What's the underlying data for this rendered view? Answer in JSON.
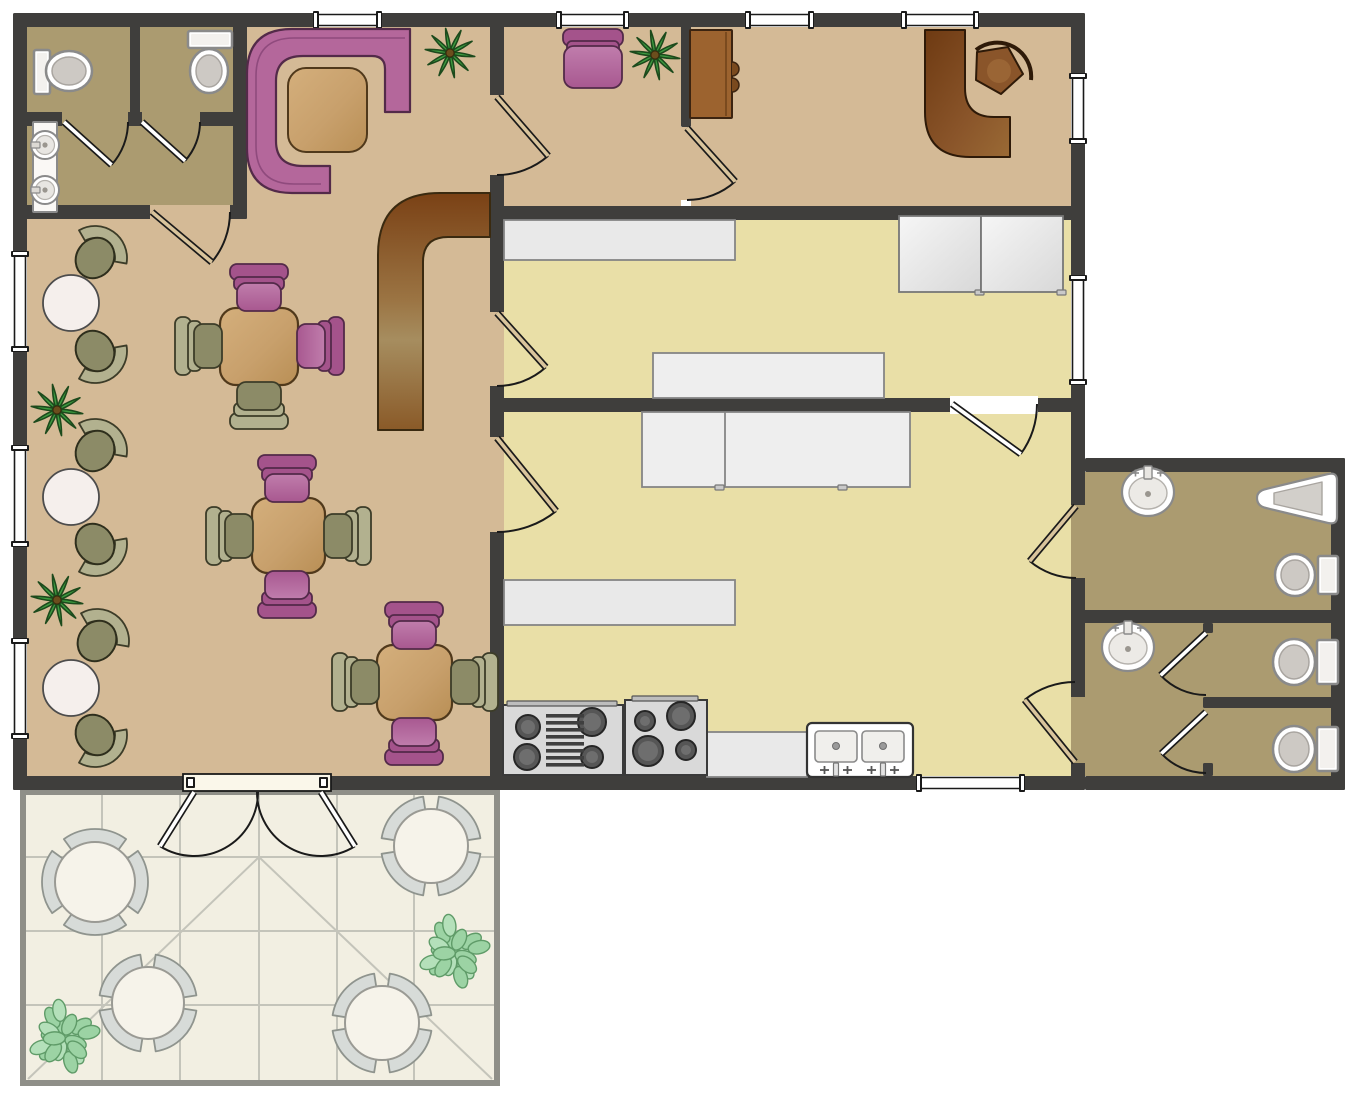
{
  "canvas": {
    "width": 1363,
    "height": 1100,
    "background": "#ffffff"
  },
  "colors": {
    "wall": "#3f3e3c",
    "dining": "#d4ba96",
    "khaki": "#ab9b70",
    "kitchen": "#e9dfa7",
    "patio": "#f2efe2",
    "patioLine": "#c4c4ba",
    "patioEdge": "#8f8f88",
    "white": "#ffffff",
    "counter": "#e9e9e9",
    "counterStroke": "#858585",
    "pink": "#b4679b",
    "pinkDark": "#a4538b",
    "pinkLight": "#c07dac",
    "pinkStroke": "#532a49",
    "olive": "#8c8b67",
    "oliveLight": "#b2b18f",
    "oliveStroke": "#3c3c28",
    "wood": "#c8a06c",
    "woodLight": "#d4af7c",
    "woodStroke": "#50391b",
    "green": "#3d9b40",
    "greenDark": "#1c4a1c",
    "bushGreen": "#9cd3a4",
    "bushGreenLight": "#b4e0ba",
    "bushStroke": "#5f9b68",
    "chairGray": "#d7dbd8",
    "chairGrayStroke": "#8f948e",
    "fixtureStroke": "#8a8a8a",
    "fixtureInner": "#d5d2cf",
    "tanDoor": "#d9c49c",
    "applianceGray": "#d9d9d9",
    "applianceStroke": "#3a3a3a",
    "burner": "#4f4f4f",
    "brownDark": "#7a4115",
    "brownMid": "#9b7443",
    "brownLight": "#a68d5f",
    "cabBrown": "#9c632f",
    "tableWhite": "#f5efec"
  },
  "floors": [
    {
      "name": "dining-room-floor",
      "x": 27,
      "y": 27,
      "w": 463,
      "h": 749,
      "fill": "dining"
    },
    {
      "name": "restroom-stalls-floor",
      "x": 27,
      "y": 27,
      "w": 206,
      "h": 85,
      "fill": "khaki"
    },
    {
      "name": "restroom-hall-floor",
      "x": 27,
      "y": 126,
      "w": 206,
      "h": 79,
      "fill": "khaki"
    },
    {
      "name": "meeting-room-floor",
      "x": 504,
      "y": 27,
      "w": 177,
      "h": 179,
      "fill": "dining"
    },
    {
      "name": "office-room-floor",
      "x": 691,
      "y": 27,
      "w": 380,
      "h": 179,
      "fill": "dining"
    },
    {
      "name": "upper-kitchen-floor",
      "x": 504,
      "y": 220,
      "w": 567,
      "h": 178,
      "fill": "kitchen"
    },
    {
      "name": "lower-kitchen-floor",
      "x": 504,
      "y": 412,
      "w": 567,
      "h": 364,
      "fill": "kitchen"
    },
    {
      "name": "bathroom-annex-floor",
      "x": 1085,
      "y": 472,
      "w": 246,
      "h": 304,
      "fill": "khaki"
    },
    {
      "name": "patio-floor",
      "x": 26,
      "y": 790,
      "w": 468,
      "h": 290,
      "fill": "patio"
    }
  ],
  "patio": {
    "border": [
      {
        "x": 20,
        "y": 790,
        "w": 6,
        "h": 296
      },
      {
        "x": 494,
        "y": 790,
        "w": 6,
        "h": 296
      },
      {
        "x": 20,
        "y": 1080,
        "w": 480,
        "h": 6
      },
      {
        "x": 20,
        "y": 790,
        "w": 480,
        "h": 5
      }
    ],
    "gridV": [
      102,
      180,
      259,
      337,
      414
    ],
    "gridH": [
      857,
      931,
      1005
    ],
    "gridTop": 795,
    "gridBottom": 1080,
    "gridLeft": 26,
    "gridRight": 494,
    "diagonals": [
      [
        259,
        857,
        28,
        1079
      ],
      [
        259,
        857,
        492,
        1079
      ]
    ]
  },
  "walls": [
    {
      "name": "outer-wall-top",
      "x": 20,
      "y": 13,
      "w": 1065,
      "h": 14
    },
    {
      "name": "outer-wall-left",
      "x": 13,
      "y": 13,
      "w": 14,
      "h": 777
    },
    {
      "name": "outer-wall-bottom",
      "x": 13,
      "y": 776,
      "w": 1072,
      "h": 14
    },
    {
      "name": "outer-wall-right",
      "x": 1071,
      "y": 13,
      "w": 14,
      "h": 777
    },
    {
      "name": "restroom-right-wall",
      "x": 233,
      "y": 13,
      "w": 14,
      "h": 206
    },
    {
      "name": "restroom-inner-wall",
      "x": 20,
      "y": 112,
      "w": 227,
      "h": 14
    },
    {
      "name": "restroom-stall-divider",
      "x": 130,
      "y": 13,
      "w": 10,
      "h": 106
    },
    {
      "name": "restroom-bottom-wall",
      "x": 20,
      "y": 205,
      "w": 227,
      "h": 14
    },
    {
      "name": "dining-kitchen-wall",
      "x": 490,
      "y": 13,
      "w": 14,
      "h": 777
    },
    {
      "name": "meeting-office-wall",
      "x": 681,
      "y": 13,
      "w": 10,
      "h": 114
    },
    {
      "name": "kitchen-top-wall",
      "x": 490,
      "y": 206,
      "w": 595,
      "h": 14
    },
    {
      "name": "kitchen-divider-wall",
      "x": 490,
      "y": 398,
      "w": 595,
      "h": 14
    },
    {
      "name": "annex-top-wall",
      "x": 1085,
      "y": 458,
      "w": 260,
      "h": 14
    },
    {
      "name": "annex-right-wall",
      "x": 1331,
      "y": 458,
      "w": 14,
      "h": 332
    },
    {
      "name": "annex-bottom-wall",
      "x": 1085,
      "y": 776,
      "w": 260,
      "h": 14
    },
    {
      "name": "annex-divider-wall",
      "x": 1078,
      "y": 610,
      "w": 267,
      "h": 13
    },
    {
      "name": "wc-stall-partition",
      "x": 1203,
      "y": 697,
      "w": 142,
      "h": 11
    },
    {
      "name": "wc-stall-stub-a",
      "x": 1203,
      "y": 623,
      "w": 10,
      "h": 10
    },
    {
      "name": "wc-stall-stub-b",
      "x": 1203,
      "y": 763,
      "w": 10,
      "h": 13
    }
  ],
  "openings": [
    {
      "x": 62,
      "y": 112,
      "w": 66,
      "h": 14,
      "fill": "khaki"
    },
    {
      "x": 142,
      "y": 112,
      "w": 58,
      "h": 14,
      "fill": "khaki"
    },
    {
      "x": 150,
      "y": 205,
      "w": 80,
      "h": 14,
      "fill": "dining"
    },
    {
      "x": 490,
      "y": 95,
      "w": 14,
      "h": 80,
      "fill": "dining"
    },
    {
      "x": 490,
      "y": 312,
      "w": 14,
      "h": 74,
      "fill": "dining"
    },
    {
      "x": 490,
      "y": 437,
      "w": 14,
      "h": 95,
      "fill": "dining"
    },
    {
      "x": 681,
      "y": 127,
      "w": 10,
      "h": 73,
      "fill": "dining"
    },
    {
      "x": 950,
      "y": 396,
      "w": 88,
      "h": 18,
      "fill": "white"
    },
    {
      "x": 1071,
      "y": 505,
      "w": 14,
      "h": 73,
      "fill": "khaki"
    },
    {
      "x": 1071,
      "y": 697,
      "w": 14,
      "h": 66,
      "fill": "khaki"
    }
  ],
  "windows": [
    {
      "name": "window",
      "x": 315,
      "y": 13,
      "w": 65,
      "h": 14
    },
    {
      "name": "window",
      "x": 558,
      "y": 13,
      "w": 69,
      "h": 14
    },
    {
      "name": "window",
      "x": 747,
      "y": 13,
      "w": 65,
      "h": 14
    },
    {
      "name": "window",
      "x": 903,
      "y": 13,
      "w": 74,
      "h": 14
    },
    {
      "name": "window",
      "x": 13,
      "y": 253,
      "w": 14,
      "h": 97
    },
    {
      "name": "window",
      "x": 13,
      "y": 447,
      "w": 14,
      "h": 98
    },
    {
      "name": "window",
      "x": 13,
      "y": 640,
      "w": 14,
      "h": 97
    },
    {
      "name": "window",
      "x": 1071,
      "y": 75,
      "w": 14,
      "h": 67
    },
    {
      "name": "window",
      "x": 1071,
      "y": 277,
      "w": 14,
      "h": 106
    },
    {
      "name": "window",
      "x": 918,
      "y": 776,
      "w": 105,
      "h": 14
    }
  ],
  "patioDoorFrame": {
    "x": 183,
    "y": 774,
    "w": 148,
    "h": 17
  },
  "doors": [
    {
      "name": "restroom-stall-1-door",
      "hx": 64,
      "hy": 122,
      "open": 42,
      "closed": 0,
      "len": 64,
      "panel": "white"
    },
    {
      "name": "restroom-stall-2-door",
      "hx": 142,
      "hy": 122,
      "open": 42,
      "closed": 0,
      "len": 58,
      "panel": "white"
    },
    {
      "name": "restroom-exit-door",
      "hx": 152,
      "hy": 212,
      "open": 40,
      "closed": 0,
      "len": 78,
      "panel": "tan"
    },
    {
      "name": "meeting-room-door",
      "hx": 497,
      "hy": 97,
      "open": 49,
      "closed": 90,
      "len": 78,
      "panel": "tan"
    },
    {
      "name": "office-door",
      "hx": 687,
      "hy": 128,
      "open": 48,
      "closed": 90,
      "len": 72,
      "panel": "tan"
    },
    {
      "name": "upper-kitchen-door",
      "hx": 497,
      "hy": 313,
      "open": 48,
      "closed": 90,
      "len": 73,
      "panel": "tan"
    },
    {
      "name": "lower-kitchen-door",
      "hx": 497,
      "hy": 438,
      "open": 51,
      "closed": 90,
      "len": 94,
      "panel": "tan"
    },
    {
      "name": "kitchen-divider-door",
      "hx": 952,
      "hy": 404,
      "open": 36,
      "closed": 0,
      "len": 85,
      "panel": "white"
    },
    {
      "name": "bathroom-1-door",
      "hx": 1076,
      "hy": 506,
      "open": 130,
      "closed": 90,
      "len": 72,
      "panel": "tan"
    },
    {
      "name": "bathroom-hall-door",
      "hx": 1075,
      "hy": 762,
      "open": 231,
      "closed": 270,
      "len": 80,
      "panel": "tan"
    },
    {
      "name": "wc-stall-1-door",
      "hx": 1206,
      "hy": 633,
      "open": 137,
      "closed": 90,
      "len": 62,
      "panel": "white"
    },
    {
      "name": "wc-stall-2-door",
      "hx": 1206,
      "hy": 712,
      "open": 137,
      "closed": 90,
      "len": 61,
      "panel": "white"
    },
    {
      "name": "patio-door-left-leaf",
      "hx": 194,
      "hy": 792,
      "open": 122,
      "closed": 0,
      "len": 64,
      "panel": "white"
    },
    {
      "name": "patio-door-right-leaf",
      "hx": 321,
      "hy": 792,
      "open": 58,
      "closed": 180,
      "len": 64,
      "panel": "white"
    }
  ],
  "furniture": [
    {
      "type": "toilet",
      "name": "toilet",
      "tank": [
        34,
        50,
        16,
        44
      ],
      "bowl": [
        69,
        71,
        23,
        20
      ]
    },
    {
      "type": "toilet",
      "name": "toilet",
      "tank": [
        188,
        31,
        44,
        17
      ],
      "bowl": [
        209,
        71,
        19,
        22
      ]
    },
    {
      "type": "sink_console",
      "name": "wash-basin-console",
      "x": 33,
      "y": 122,
      "w": 24,
      "h": 90,
      "sinks": [
        [
          45,
          145
        ],
        [
          45,
          190
        ]
      ]
    },
    {
      "type": "booth",
      "name": "corner-booth-sofa"
    },
    {
      "type": "booth_table",
      "name": "booth-table",
      "x": 288,
      "y": 68,
      "w": 79,
      "h": 84
    },
    {
      "type": "bar",
      "name": "bar-counter"
    },
    {
      "type": "plant",
      "name": "potted-plant",
      "cx": 450,
      "cy": 53,
      "r": 25
    },
    {
      "type": "plant",
      "name": "potted-plant",
      "cx": 655,
      "cy": 55,
      "r": 25
    },
    {
      "type": "plant",
      "name": "potted-plant",
      "cx": 57,
      "cy": 410,
      "r": 26
    },
    {
      "type": "plant",
      "name": "potted-plant",
      "cx": 57,
      "cy": 600,
      "r": 26
    },
    {
      "type": "duo",
      "name": "bistro-table-set",
      "table": [
        71,
        303,
        28
      ],
      "chairs": [
        [
          95,
          258,
          -55
        ],
        [
          95,
          351,
          55
        ]
      ]
    },
    {
      "type": "duo",
      "name": "bistro-table-set",
      "table": [
        71,
        497,
        28
      ],
      "chairs": [
        [
          95,
          451,
          -55
        ],
        [
          95,
          544,
          55
        ]
      ]
    },
    {
      "type": "duo",
      "name": "bistro-table-set",
      "table": [
        71,
        688,
        28
      ],
      "chairs": [
        [
          97,
          641,
          -55
        ],
        [
          95,
          735,
          55
        ]
      ]
    },
    {
      "type": "table",
      "name": "dining-table",
      "x": 220,
      "y": 308,
      "w": 78,
      "h": 77
    },
    {
      "type": "sq_chair",
      "name": "dining-chair",
      "cx": 259,
      "cy": 292,
      "rot": 0,
      "color": "pink"
    },
    {
      "type": "sq_chair",
      "name": "dining-chair",
      "cx": 316,
      "cy": 346,
      "rot": 90,
      "color": "pink"
    },
    {
      "type": "sq_chair",
      "name": "dining-chair",
      "cx": 259,
      "cy": 401,
      "rot": 180,
      "color": "olive"
    },
    {
      "type": "sq_chair",
      "name": "dining-chair",
      "cx": 203,
      "cy": 346,
      "rot": 270,
      "color": "olive"
    },
    {
      "type": "table",
      "name": "dining-table",
      "x": 252,
      "y": 498,
      "w": 73,
      "h": 75
    },
    {
      "type": "sq_chair",
      "name": "dining-chair",
      "cx": 287,
      "cy": 483,
      "rot": 0,
      "color": "pink"
    },
    {
      "type": "sq_chair",
      "name": "dining-chair",
      "cx": 287,
      "cy": 590,
      "rot": 180,
      "color": "pink"
    },
    {
      "type": "sq_chair",
      "name": "dining-chair",
      "cx": 234,
      "cy": 536,
      "rot": 270,
      "color": "olive"
    },
    {
      "type": "sq_chair",
      "name": "dining-chair",
      "cx": 343,
      "cy": 536,
      "rot": 90,
      "color": "olive"
    },
    {
      "type": "table",
      "name": "dining-table",
      "x": 377,
      "y": 645,
      "w": 75,
      "h": 75
    },
    {
      "type": "sq_chair",
      "name": "dining-chair",
      "cx": 414,
      "cy": 630,
      "rot": 0,
      "color": "pink"
    },
    {
      "type": "sq_chair",
      "name": "dining-chair",
      "cx": 414,
      "cy": 737,
      "rot": 180,
      "color": "pink"
    },
    {
      "type": "sq_chair",
      "name": "dining-chair",
      "cx": 360,
      "cy": 682,
      "rot": 270,
      "color": "olive"
    },
    {
      "type": "sq_chair",
      "name": "dining-chair",
      "cx": 470,
      "cy": 682,
      "rot": 90,
      "color": "olive"
    },
    {
      "type": "armchair",
      "name": "armchair",
      "cx": 593,
      "cy": 58
    },
    {
      "type": "wood_cabinet",
      "name": "cabinet",
      "x": 690,
      "y": 30,
      "w": 42,
      "h": 88
    },
    {
      "type": "desk",
      "name": "reception-desk"
    },
    {
      "type": "desk_chair",
      "name": "office-chair"
    },
    {
      "type": "counter",
      "name": "kitchen-counter",
      "x": 504,
      "y": 220,
      "w": 231,
      "h": 40
    },
    {
      "type": "cabinet",
      "name": "kitchen-cabinet",
      "x": 899,
      "y": 216,
      "w": 82,
      "h": 76,
      "handle": [
        975,
        290
      ]
    },
    {
      "type": "cabinet",
      "name": "kitchen-cabinet",
      "x": 981,
      "y": 216,
      "w": 82,
      "h": 76,
      "handle": [
        1057,
        290
      ]
    },
    {
      "type": "island",
      "name": "kitchen-island",
      "x": 653,
      "y": 353,
      "w": 231,
      "h": 45,
      "divider": 0,
      "handles": []
    },
    {
      "type": "island",
      "name": "kitchen-island",
      "x": 642,
      "y": 412,
      "w": 268,
      "h": 75,
      "divider": 725,
      "handles": [
        715,
        838
      ]
    },
    {
      "type": "counter",
      "name": "kitchen-counter",
      "x": 504,
      "y": 580,
      "w": 231,
      "h": 45
    },
    {
      "type": "counter",
      "name": "kitchen-counter",
      "x": 707,
      "y": 732,
      "w": 100,
      "h": 45
    },
    {
      "type": "stove1",
      "name": "range-with-griddle",
      "x": 503,
      "y": 705,
      "w": 120,
      "h": 70
    },
    {
      "type": "stove2",
      "name": "four-burner-range",
      "x": 625,
      "y": 700,
      "w": 82,
      "h": 75
    },
    {
      "type": "dsink",
      "name": "double-sink",
      "x": 807,
      "y": 723,
      "w": 106,
      "h": 54
    },
    {
      "type": "round_sink",
      "name": "bathroom-sink",
      "cx": 1148,
      "cy": 492
    },
    {
      "type": "round_sink",
      "name": "bathroom-sink",
      "cx": 1128,
      "cy": 647
    },
    {
      "type": "urinal",
      "name": "urinal"
    },
    {
      "type": "toilet",
      "name": "toilet",
      "tank": [
        1318,
        556,
        20,
        38
      ],
      "bowl": [
        1295,
        575,
        20,
        21
      ]
    },
    {
      "type": "toilet",
      "name": "toilet",
      "tank": [
        1317,
        640,
        21,
        44
      ],
      "bowl": [
        1294,
        662,
        21,
        23
      ]
    },
    {
      "type": "toilet",
      "name": "toilet",
      "tank": [
        1317,
        727,
        21,
        44
      ],
      "bowl": [
        1294,
        749,
        21,
        23
      ]
    },
    {
      "type": "patio_table",
      "name": "patio-table-set",
      "cx": 95,
      "cy": 882,
      "r": 40,
      "angles": [
        0,
        90,
        180,
        270
      ]
    },
    {
      "type": "patio_table",
      "name": "patio-table-set",
      "cx": 431,
      "cy": 846,
      "r": 37,
      "angles": [
        45,
        135,
        225,
        315
      ]
    },
    {
      "type": "patio_table",
      "name": "patio-table-set",
      "cx": 148,
      "cy": 1003,
      "r": 36,
      "angles": [
        45,
        135,
        225,
        315
      ]
    },
    {
      "type": "patio_table",
      "name": "patio-table-set",
      "cx": 382,
      "cy": 1023,
      "r": 37,
      "angles": [
        45,
        135,
        225,
        315
      ]
    },
    {
      "type": "bush",
      "name": "shrub",
      "cx": 453,
      "cy": 953,
      "r": 34
    },
    {
      "type": "bush",
      "name": "shrub",
      "cx": 63,
      "cy": 1038,
      "r": 34
    }
  ]
}
